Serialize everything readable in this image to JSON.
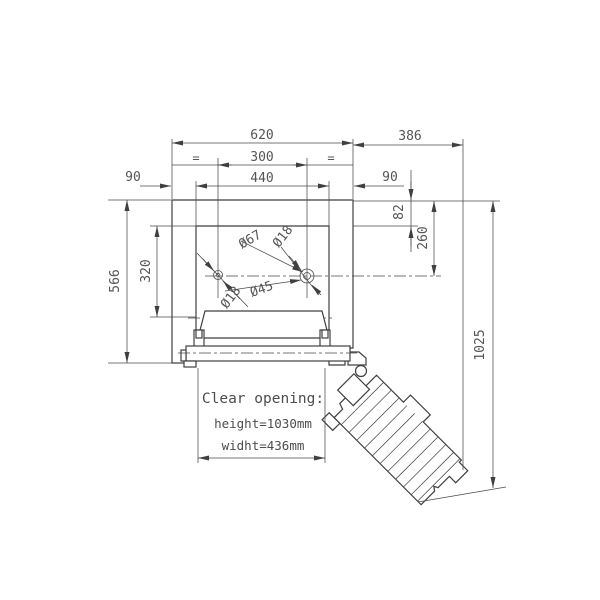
{
  "colors": {
    "line": "#3f3f3f",
    "text": "#555555",
    "background": "#ffffff"
  },
  "drawing": {
    "dimensions": {
      "top_width": "620",
      "side_extension": "386",
      "hinge_spacing": "300",
      "opening_width": "440",
      "left_margin": "90",
      "right_margin": "90",
      "frame_height": "566",
      "opening_height": "320",
      "top_inset": "82",
      "hinge_offset": "260",
      "overall_height": "1025"
    },
    "diameters": {
      "boss_large": "Ø67",
      "pin_right": "Ø18",
      "boss_small": "Ø45",
      "pin_left": "Ø18"
    },
    "equal_mark": "=",
    "clear_opening": {
      "heading": "Clear opening:",
      "height": "height=1030mm",
      "width": "widht=436mm"
    }
  }
}
